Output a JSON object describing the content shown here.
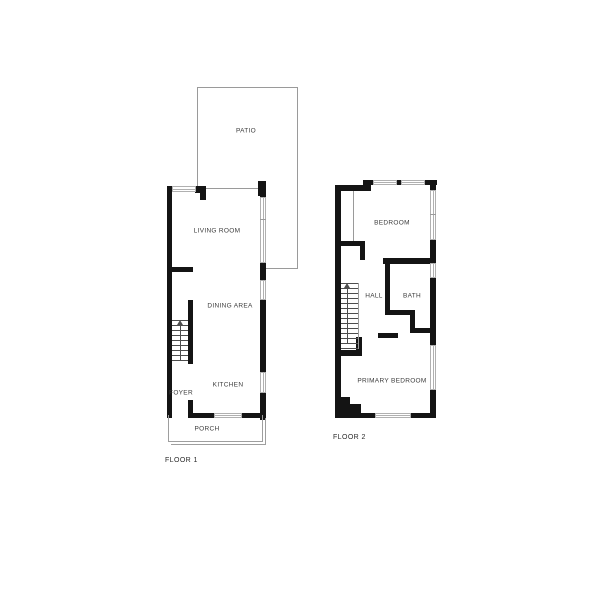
{
  "floor1": {
    "tag": "FLOOR 1",
    "patio": "PATIO",
    "living_room": "LIVING ROOM",
    "dining_area": "DINING AREA",
    "kitchen": "KITCHEN",
    "foyer": "FOYER",
    "porch": "PORCH"
  },
  "floor2": {
    "tag": "FLOOR 2",
    "bedroom": "BEDROOM",
    "hall": "HALL",
    "bath": "BATH",
    "primary_bedroom": "PRIMARY BEDROOM"
  },
  "colors": {
    "background": "#ffffff",
    "wall": "#141414",
    "window": "#b0b0b0",
    "outline": "#9e9e9e",
    "label": "#3c3c3c"
  }
}
